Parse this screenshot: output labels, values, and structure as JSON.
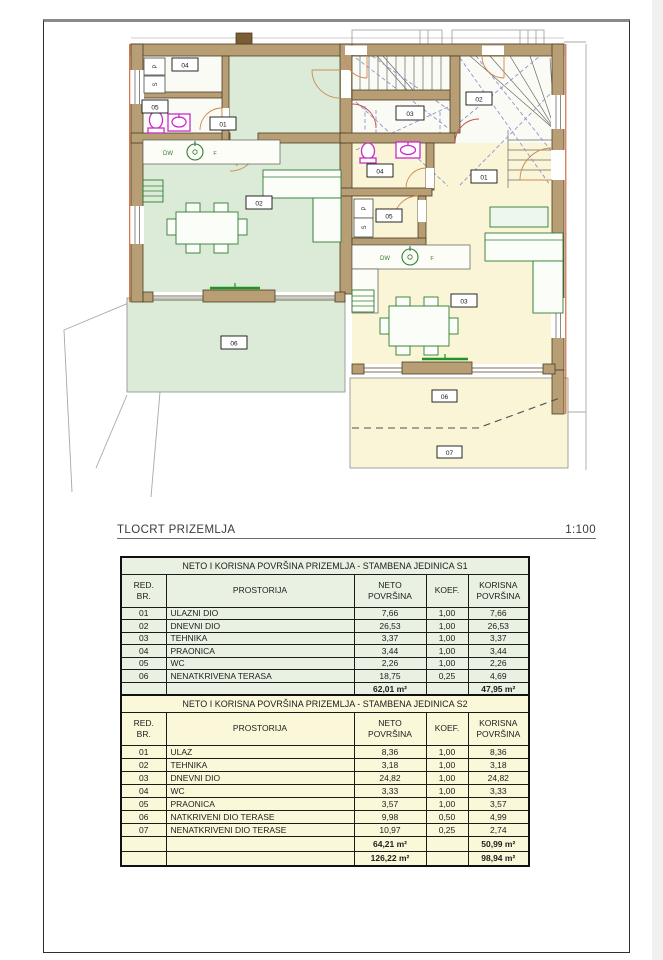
{
  "drawing": {
    "title": "TLOCRT PRIZEMLJA",
    "scale": "1:100"
  },
  "plan": {
    "kitchen": {
      "dw": "DW",
      "hob_mark": "F"
    },
    "appliances": {
      "washer": "P",
      "dryer": "S"
    },
    "unit1_labels": {
      "entry": "01",
      "living": "02",
      "tech": "03",
      "laundry": "04",
      "wc": "05",
      "terrace": "06"
    },
    "unit2_labels": {
      "entry": "01",
      "tech": "02",
      "living": "03",
      "wc": "04",
      "laundry": "05",
      "terrace_covered": "06",
      "terrace_open": "07"
    },
    "colors": {
      "wall": "#b89e75",
      "unit1_floor": "#dcebd7",
      "unit2_floor": "#f9f5d6",
      "stairs_floor": "#fbfbf5",
      "fixture": "#c92bc9",
      "furniture": "#2f7d32",
      "hatch": "#8f92cf",
      "door": "#cf8a52",
      "accent": "#cf5f2b"
    }
  },
  "tables": [
    {
      "title": "NETO I KORISNA POVRŠINA PRIZEMLJA - STAMBENA JEDINICA S1",
      "headers": {
        "red": "RED.",
        "br": "BR.",
        "prostorija": "PROSTORIJA",
        "neto1": "NETO",
        "neto2": "POVRŠINA",
        "koef": "KOEF.",
        "korisna1": "KORISNA",
        "korisna2": "POVRŠINA"
      },
      "rows": [
        {
          "num": "01",
          "name": "ULAZNI DIO",
          "neto": "7,66",
          "koef": "1,00",
          "korisna": "7,66"
        },
        {
          "num": "02",
          "name": "DNEVNI DIO",
          "neto": "26,53",
          "koef": "1,00",
          "korisna": "26,53"
        },
        {
          "num": "03",
          "name": "TEHNIKA",
          "neto": "3,37",
          "koef": "1,00",
          "korisna": "3,37"
        },
        {
          "num": "04",
          "name": "PRAONICA",
          "neto": "3,44",
          "koef": "1,00",
          "korisna": "3,44"
        },
        {
          "num": "05",
          "name": "WC",
          "neto": "2,26",
          "koef": "1,00",
          "korisna": "2,26"
        },
        {
          "num": "06",
          "name": "NENATKRIVENA TERASA",
          "neto": "18,75",
          "koef": "0,25",
          "korisna": "4,69"
        }
      ],
      "total": {
        "neto": "62,01 m²",
        "korisna": "47,95 m²"
      }
    },
    {
      "title": "NETO I KORISNA POVRŠINA PRIZEMLJA - STAMBENA JEDINICA S2",
      "headers": {
        "red": "RED.",
        "br": "BR.",
        "prostorija": "PROSTORIJA",
        "neto1": "NETO",
        "neto2": "POVRŠINA",
        "koef": "KOEF.",
        "korisna1": "KORISNA",
        "korisna2": "POVRŠINA"
      },
      "rows": [
        {
          "num": "01",
          "name": "ULAZ",
          "neto": "8,36",
          "koef": "1,00",
          "korisna": "8,36"
        },
        {
          "num": "02",
          "name": "TEHNIKA",
          "neto": "3,18",
          "koef": "1,00",
          "korisna": "3,18"
        },
        {
          "num": "03",
          "name": "DNEVNI DIO",
          "neto": "24,82",
          "koef": "1,00",
          "korisna": "24,82"
        },
        {
          "num": "04",
          "name": "WC",
          "neto": "3,33",
          "koef": "1,00",
          "korisna": "3,33"
        },
        {
          "num": "05",
          "name": "PRAONICA",
          "neto": "3,57",
          "koef": "1,00",
          "korisna": "3,57"
        },
        {
          "num": "06",
          "name": "NATKRIVENI DIO TERASE",
          "neto": "9,98",
          "koef": "0,50",
          "korisna": "4,99"
        },
        {
          "num": "07",
          "name": "NENATKRIVENI DIO TERASE",
          "neto": "10,97",
          "koef": "0,25",
          "korisna": "2,74"
        }
      ],
      "total": {
        "neto": "64,21 m²",
        "korisna": "50,99 m²"
      },
      "grand_total": {
        "neto": "126,22 m²",
        "korisna": "98,94 m²"
      }
    }
  ]
}
